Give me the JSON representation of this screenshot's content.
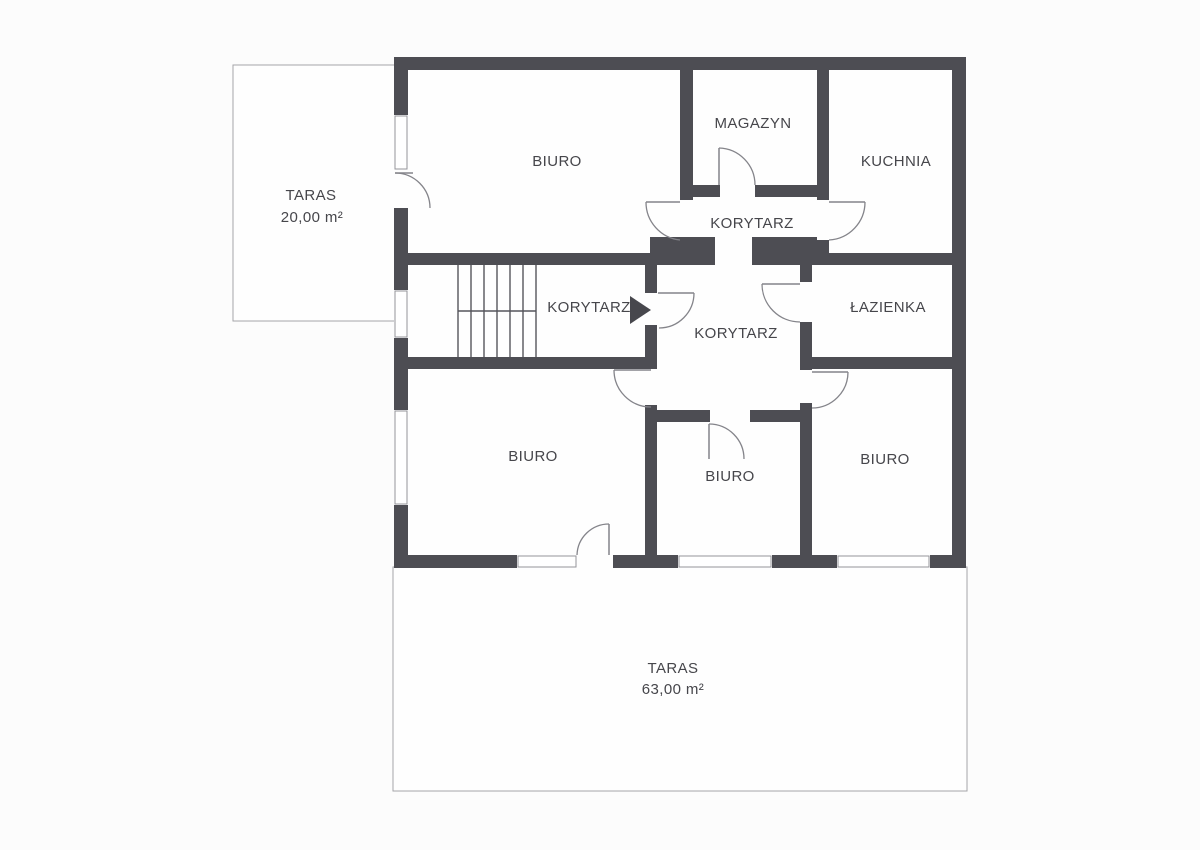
{
  "plan": {
    "type": "floor-plan",
    "language": "pl",
    "rooms": [
      {
        "id": "biuro-top-left",
        "label": "BIURO"
      },
      {
        "id": "magazyn",
        "label": "MAGAZYN"
      },
      {
        "id": "kuchnia",
        "label": "KUCHNIA"
      },
      {
        "id": "korytarz-top",
        "label": "KORYTARZ"
      },
      {
        "id": "korytarz-stairs",
        "label": "KORYTARZ"
      },
      {
        "id": "korytarz-center",
        "label": "KORYTARZ"
      },
      {
        "id": "lazienka",
        "label": "ŁAZIENKA"
      },
      {
        "id": "biuro-bottom-left",
        "label": "BIURO"
      },
      {
        "id": "biuro-bottom-middle",
        "label": "BIURO"
      },
      {
        "id": "biuro-bottom-right",
        "label": "BIURO"
      },
      {
        "id": "taras-small",
        "label": "TARAS",
        "area": "20,00 m²"
      },
      {
        "id": "taras-large",
        "label": "TARAS",
        "area": "63,00 m²"
      }
    ],
    "entrance": {
      "marker": "arrow",
      "direction": "right"
    },
    "colors": {
      "wall": "#4d4d53",
      "door_line": "#84848a",
      "text": "#46464b",
      "background": "#fcfcfc"
    },
    "features": {
      "staircase_flights": 2,
      "staircase_treads": 6,
      "windows": 6,
      "interior_doors": 9
    }
  }
}
